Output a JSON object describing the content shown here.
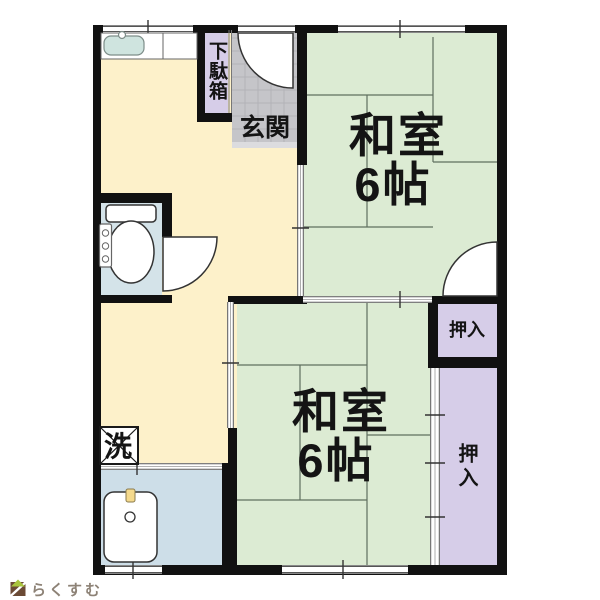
{
  "floorplan": {
    "rooms": {
      "washitsu_top": {
        "line1": "和室",
        "line2": "6帖"
      },
      "washitsu_bottom": {
        "line1": "和室",
        "line2": "6帖"
      },
      "genkan": {
        "label": "玄関"
      },
      "getabako": {
        "label": "下駄箱"
      },
      "oshiire_small": {
        "label": "押入"
      },
      "oshiire_large": {
        "label": "押入"
      },
      "laundry": {
        "label": "洗"
      }
    },
    "colors": {
      "wall": "#111111",
      "tatami_room": "#dcebd3",
      "hall_kitchen": "#fdf1ca",
      "closet": "#d6cde8",
      "entrance_tile": "#c5c5c9",
      "bathroom": "#cddee8",
      "toilet_room": "#d4e3e9",
      "kitchen_sink": "#cfe4df"
    }
  },
  "watermark": {
    "brand": "らくすむ"
  }
}
